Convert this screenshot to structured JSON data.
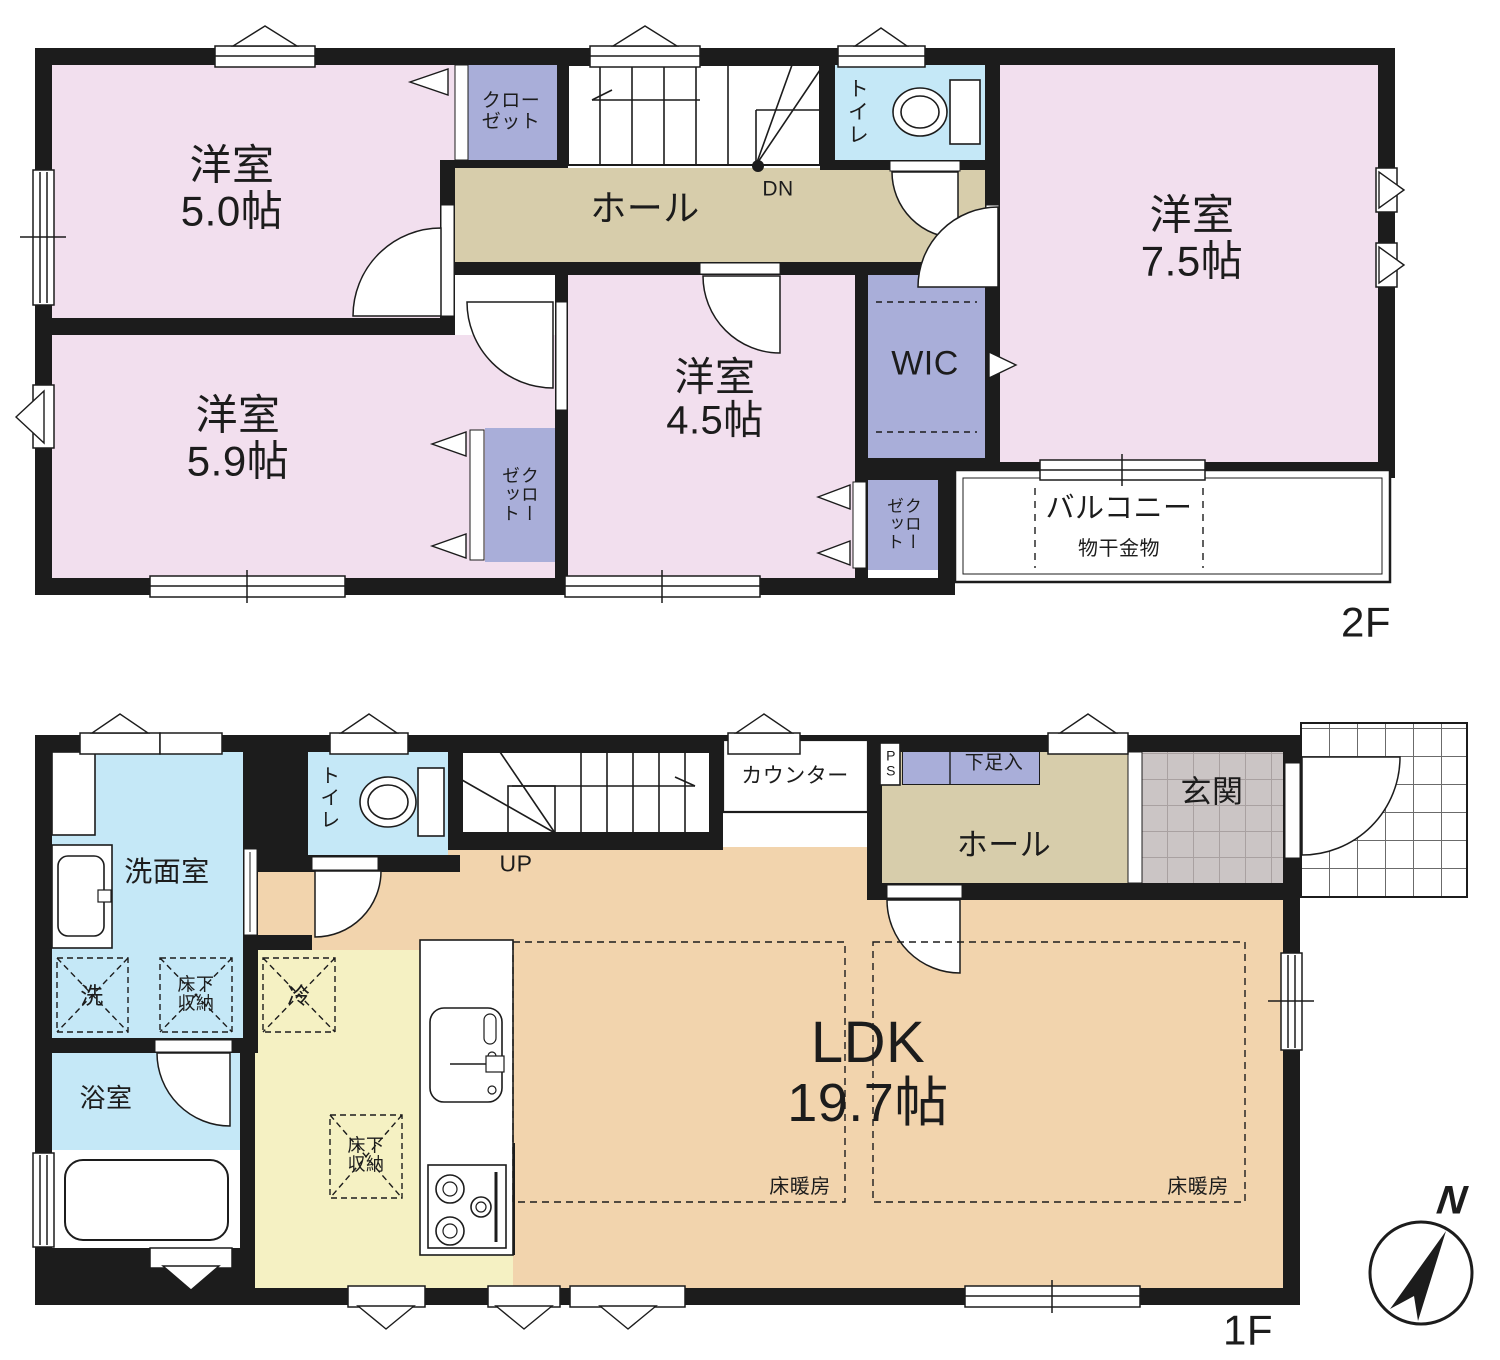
{
  "colors": {
    "wall": "#1c1c1c",
    "room_pink": "#f2dfee",
    "closet_purple": "#a9aed9",
    "hall_tan": "#d7cdab",
    "water_blue": "#c5e8f7",
    "ldk_peach": "#f2d4ad",
    "kitchen_yellow": "#f5f1c3",
    "genkan_gray": "#cbc5c5",
    "line": "#1c1c1c"
  },
  "floor2": {
    "floor_label": "2F",
    "rooms": {
      "yoshitsu50": {
        "name": "洋室",
        "size": "5.0帖"
      },
      "yoshitsu59": {
        "name": "洋室",
        "size": "5.9帖"
      },
      "yoshitsu45": {
        "name": "洋室",
        "size": "4.5帖"
      },
      "yoshitsu75": {
        "name": "洋室",
        "size": "7.5帖"
      },
      "hall": {
        "name": "ホール"
      },
      "toilet": {
        "name": "トイレ"
      },
      "wic": {
        "name": "WIC"
      },
      "closet_top": {
        "name": "クローゼット"
      },
      "closet_mid": {
        "name": "クローゼット"
      },
      "closet_right": {
        "name": "クローゼット"
      },
      "balcony": {
        "name": "バルコニー",
        "note": "物干金物"
      },
      "stairs": {
        "label": "DN"
      }
    }
  },
  "floor1": {
    "floor_label": "1F",
    "compass": "N",
    "rooms": {
      "ldk": {
        "name": "LDK",
        "size": "19.7帖"
      },
      "floor_heating_left": {
        "name": "床暖房"
      },
      "floor_heating_right": {
        "name": "床暖房"
      },
      "senmen": {
        "name": "洗面室"
      },
      "yokushitsu": {
        "name": "浴室"
      },
      "toilet": {
        "name": "トイレ"
      },
      "hall": {
        "name": "ホール"
      },
      "genkan": {
        "name": "玄関"
      },
      "counter": {
        "name": "カウンター"
      },
      "ps": {
        "name": "PS"
      },
      "shoe_box": {
        "name": "下足入"
      },
      "washer": {
        "name": "洗"
      },
      "underfloor_storage_a": {
        "name": "床下収納"
      },
      "underfloor_storage_b": {
        "name": "床下収納"
      },
      "fridge": {
        "name": "冷"
      },
      "stairs": {
        "label": "UP"
      }
    }
  }
}
